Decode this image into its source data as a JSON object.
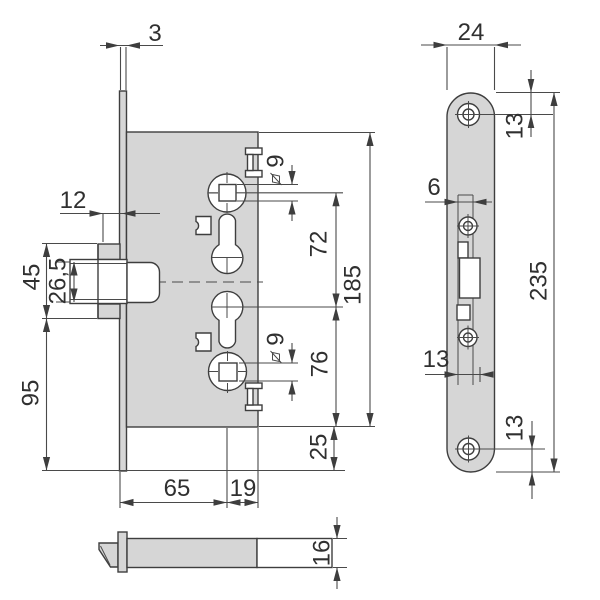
{
  "drawing": {
    "type": "technical-drawing",
    "subject": "mortise-lock",
    "colors": {
      "part_fill": "#d6d6d6",
      "line": "#3e3e3e",
      "background": "#ffffff"
    },
    "dims": {
      "faceplate_thickness": "3",
      "latch_projection": "12",
      "latch_case_height": "45",
      "latch_bolt_height": "26,5",
      "plate_below_case": "95",
      "follower_square_top": "9",
      "follower_square_bottom": "9",
      "follower_to_cylinder": "72",
      "case_height": "185",
      "cylinder_to_case_bottom": "76",
      "case_to_plate_end": "25",
      "backset": "65",
      "case_rear": "19",
      "case_thickness": "16",
      "plate_width": "24",
      "plate_top_to_hole": "13",
      "strip_width": "6",
      "cutout_width": "13",
      "plate_length": "235",
      "hole_to_plate_bottom": "13"
    }
  }
}
